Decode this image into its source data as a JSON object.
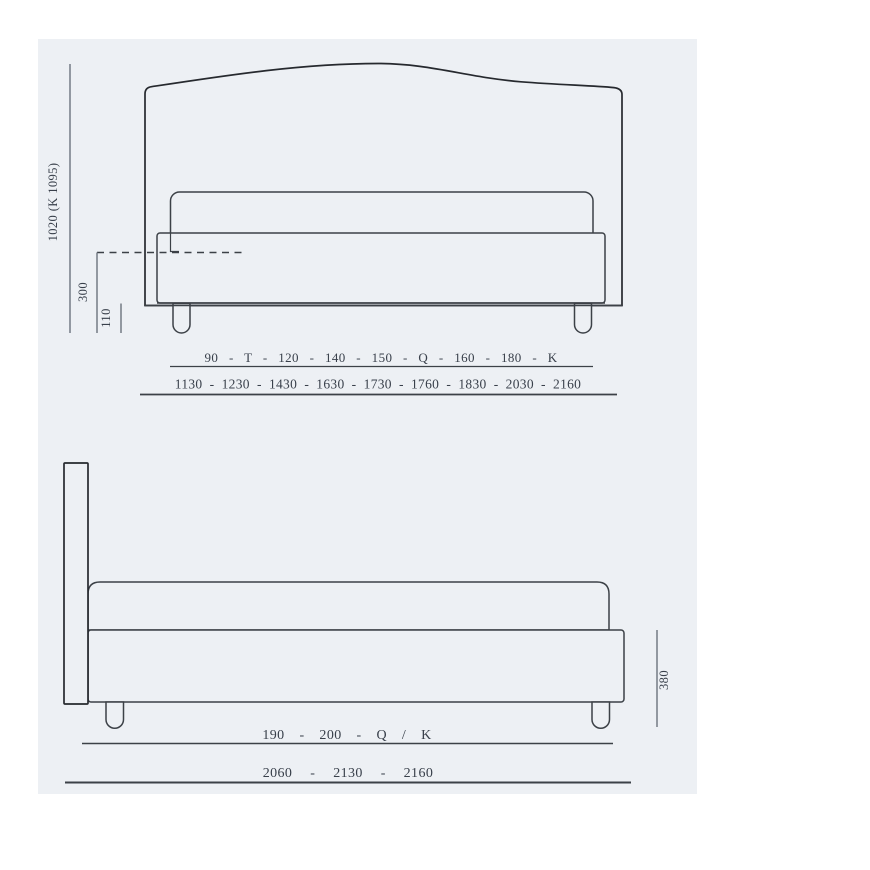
{
  "colors": {
    "page_background": "#ffffff",
    "panel_background": "#edf0f4",
    "drawing_line": "#3c4147",
    "dimension_line": "#747b85",
    "text": "#39404b"
  },
  "front_view": {
    "dim_total_height": "1020 (K 1095)",
    "dim_platform_height": "300",
    "dim_leg_height": "110",
    "size_names_row": "90 - T - 120 - 140 - 150 - Q - 160 - 180 - K",
    "size_widths_row": "1130 - 1230 - 1430 - 1630 - 1730 - 1760 - 1830 - 2030 - 2160",
    "size_names": [
      "90",
      "T",
      "120",
      "140",
      "150",
      "Q",
      "160",
      "180",
      "K"
    ],
    "size_widths_mm": [
      1130,
      1230,
      1430,
      1630,
      1730,
      1760,
      1830,
      2030,
      2160
    ]
  },
  "side_view": {
    "dim_base_height": "380",
    "size_names_row": "190 - 200 - Q / K",
    "size_lengths_row": "2060 - 2130 - 2160",
    "size_names": [
      "190",
      "200",
      "Q / K"
    ],
    "size_lengths_mm": [
      2060,
      2130,
      2160
    ]
  }
}
